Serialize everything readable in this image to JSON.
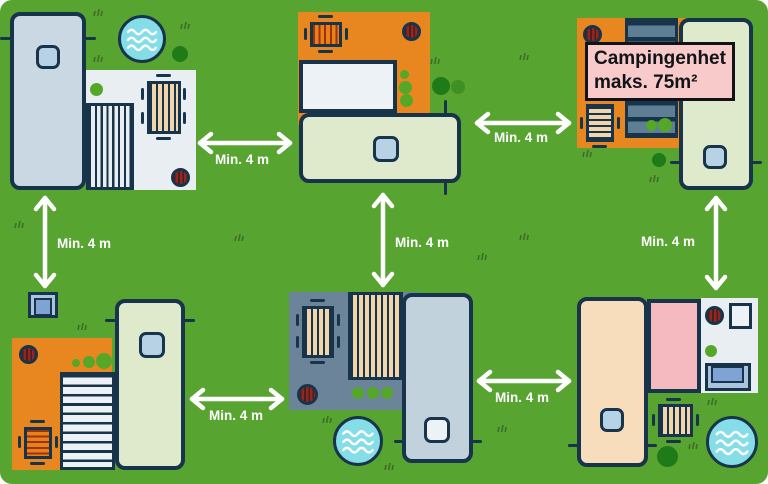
{
  "callout": {
    "line1": "Campingenhet",
    "line2": "maks. 75m²"
  },
  "arrows": [
    {
      "id": "top-left-to-top-middle",
      "orientation": "horizontal",
      "label": "Min. 4 m"
    },
    {
      "id": "top-left-to-bottom-left",
      "orientation": "vertical",
      "label": "Min. 4 m"
    },
    {
      "id": "top-middle-to-top-right",
      "orientation": "horizontal",
      "label": "Min. 4 m"
    },
    {
      "id": "top-middle-to-bottom-middle",
      "orientation": "vertical",
      "label": "Min. 4 m"
    },
    {
      "id": "top-right-to-bottom-right",
      "orientation": "vertical",
      "label": "Min. 4 m"
    },
    {
      "id": "bottom-left-to-bottom-middle",
      "orientation": "horizontal",
      "label": "Min. 4 m"
    },
    {
      "id": "bottom-middle-to-bottom-right",
      "orientation": "horizontal",
      "label": "Min. 4 m"
    }
  ],
  "icons": {
    "grass_tuft_glyph": "ılı"
  },
  "palette": {
    "grass": "#58a431",
    "outline": "#17344a",
    "arrow_white": "#ffffff",
    "orange_terrace": "#e8871f",
    "slate_terrace": "#6b8499",
    "white_terrace": "#e9eef3",
    "deck_slate": "#5e7e94",
    "caravan_blue": "#c9d8e2",
    "caravan_green": "#dfe9cb",
    "caravan_peach": "#f8ddbc",
    "caravan_slate": "#c2d2dd",
    "window_blue": "#b7d1e5",
    "window_white": "#edf2f6",
    "annex_pink": "#f4bac0",
    "callout_pink": "#f9caca",
    "pool_blue": "#85dde7",
    "fire_red": "#93261f",
    "wood_tan": "#f3d5ab",
    "table_orange": "#ea8018",
    "table_orange_stripe": "#9c3310",
    "bush_bright": "#55a728",
    "bush_mid": "#3f9022",
    "bush_dark": "#1f7a18",
    "tuft_green": "#3c6e28",
    "shed_light": "#a9c4df",
    "shed_dark": "#7fa3d2"
  }
}
